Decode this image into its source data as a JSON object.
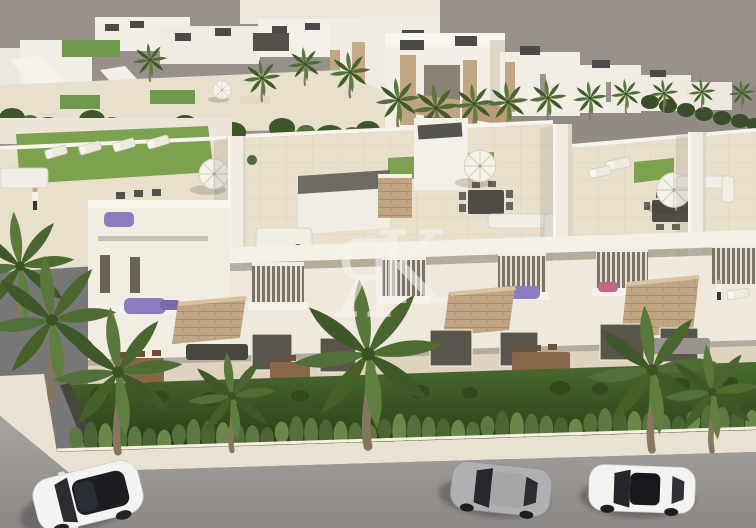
{
  "watermark": {
    "letters": [
      "Я",
      "K"
    ],
    "color": "#f8f6f2",
    "opacity": 0.58
  },
  "colors": {
    "sky": "#98908b",
    "terrain": "#8e8680",
    "wall_light": "#f4f0e7",
    "wall_mid": "#eae4d8",
    "wall_shade": "#d9d1c2",
    "roof_box": "#4b4a47",
    "terrace_floor": "#e9e0cc",
    "roof_lawn": "#7ca24f",
    "garden_top": "#4a6b30",
    "garden_bottom": "#263c16",
    "stone": "#c2a585",
    "stone_line": "#a98e6f",
    "glass": "#696259",
    "glass_dark": "#24262a",
    "sidewalk": "#e9e2d2",
    "curb": "#f6f0e2",
    "road_top": "#a7a3a1",
    "road_bottom": "#8c8886",
    "wood": "#8a6648",
    "furniture_white": "#f2eee6",
    "furniture_gray": "#9a958c",
    "furniture_dark": "#55504a",
    "flower_purple": "#8d7cc0",
    "flower_pink": "#c06a8a",
    "umbrella": "#f5f2ea",
    "palm_dark": "#3f5829",
    "palm_mid": "#4f6c33",
    "palm_light": "#5f7f3e",
    "trunk": "#857660",
    "car_white": "#f3f3f1",
    "car_silver": "#b0b0b3",
    "car_glass": "#1d1f23"
  },
  "scene": {
    "subject": "aerial render of white townhouse development with rooftop solariums",
    "cars": [
      {
        "name": "white-suv",
        "position": "bottom-left"
      },
      {
        "name": "silver-coupe",
        "position": "bottom-center-right"
      },
      {
        "name": "white-sedan",
        "position": "bottom-right"
      }
    ],
    "umbrella_count": 4,
    "hedge": {
      "count": 47,
      "x_start": 76,
      "x_end": 752,
      "y_start": 441,
      "y_end": 423,
      "rx": 7,
      "ry_min": 11,
      "ry_max": 17,
      "colors": [
        "#5d7842",
        "#4c6434",
        "#6b8749",
        "#55703c"
      ]
    }
  }
}
